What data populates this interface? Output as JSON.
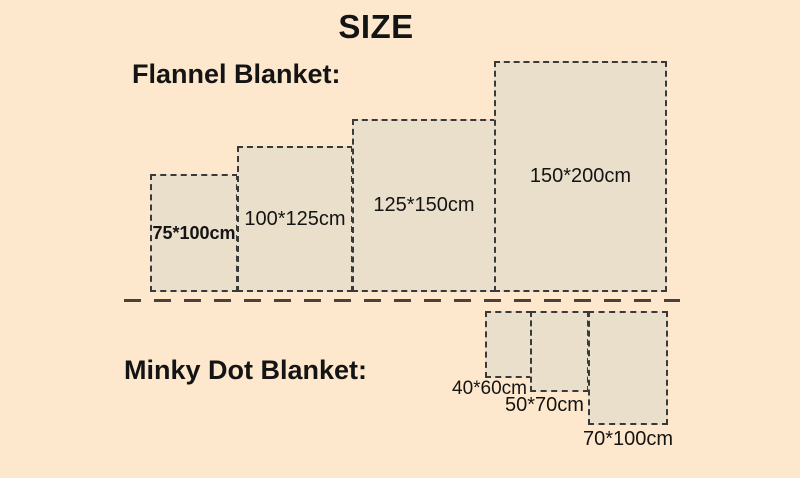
{
  "title": "SIZE",
  "flannel": {
    "label": "Flannel Blanket:",
    "sizes": [
      "75*100cm",
      "100*125cm",
      "125*150cm",
      "150*200cm"
    ]
  },
  "minky": {
    "label": "Minky Dot Blanket:",
    "sizes": [
      "40*60cm",
      "50*70cm",
      "70*100cm"
    ]
  },
  "colors": {
    "background": "#fde8cd",
    "rect_fill": "#e9dfca",
    "rect_border": "#3a3a3a",
    "divider": "#4a4239",
    "text": "#141414"
  }
}
